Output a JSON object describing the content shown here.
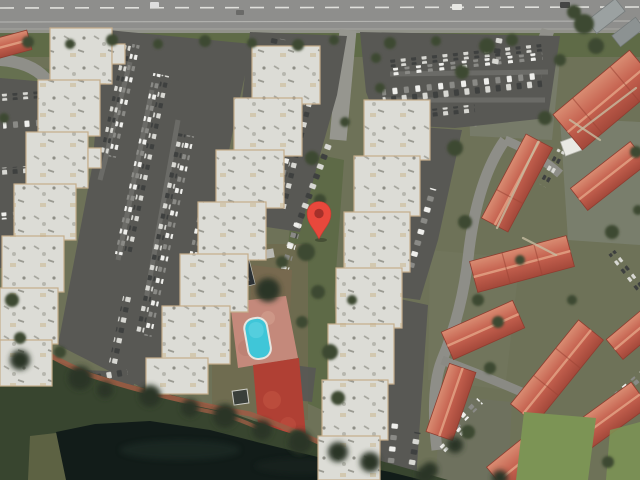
{
  "meta": {
    "width": 640,
    "height": 480,
    "view_type": "satellite-imagery",
    "app": "map-viewer"
  },
  "marker": {
    "name": "location-marker-pin",
    "tip_x": 319,
    "tip_y": 239,
    "color": "#E8483C",
    "dot_color": "#A5302A",
    "outline": "#C23A30"
  },
  "palette": {
    "road": "#8E8E8C",
    "road_line": "#E0E0DC",
    "asphalt": "#585854",
    "building_roof": "#DCDCD6",
    "building_edge": "#C5AD8B",
    "red_roof_light": "#D98C72",
    "red_roof_mid": "#C4604E",
    "red_roof_dark": "#A3483A",
    "grass": "#6E7258",
    "grass_dark": "#5E6A47",
    "lawn": "#7C9455",
    "tree": "#3C4A31",
    "tree_dark": "#2A3625",
    "water": "#121C19",
    "pool_water": "#3FC6D8",
    "pool_deck": "#C4897B",
    "clay_court": "#B04034",
    "sport_court": "#2C3134",
    "dirt_path": "#9C5C45",
    "car_light": "#D8D8D3",
    "car_dark": "#3E403F"
  },
  "features": [
    "main-road",
    "roadside-median-trees",
    "entrance-driveways",
    "white-apartment-building-west",
    "white-apartment-building-center",
    "white-apartment-building-east",
    "red-roof-condo-cluster",
    "parking-lots-with-cars",
    "swimming-pool",
    "pool-deck",
    "sports-court",
    "clay-court",
    "gazebo",
    "pond",
    "shoreline-tree-band",
    "dirt-footpath",
    "lawn",
    "location-marker-pin"
  ]
}
